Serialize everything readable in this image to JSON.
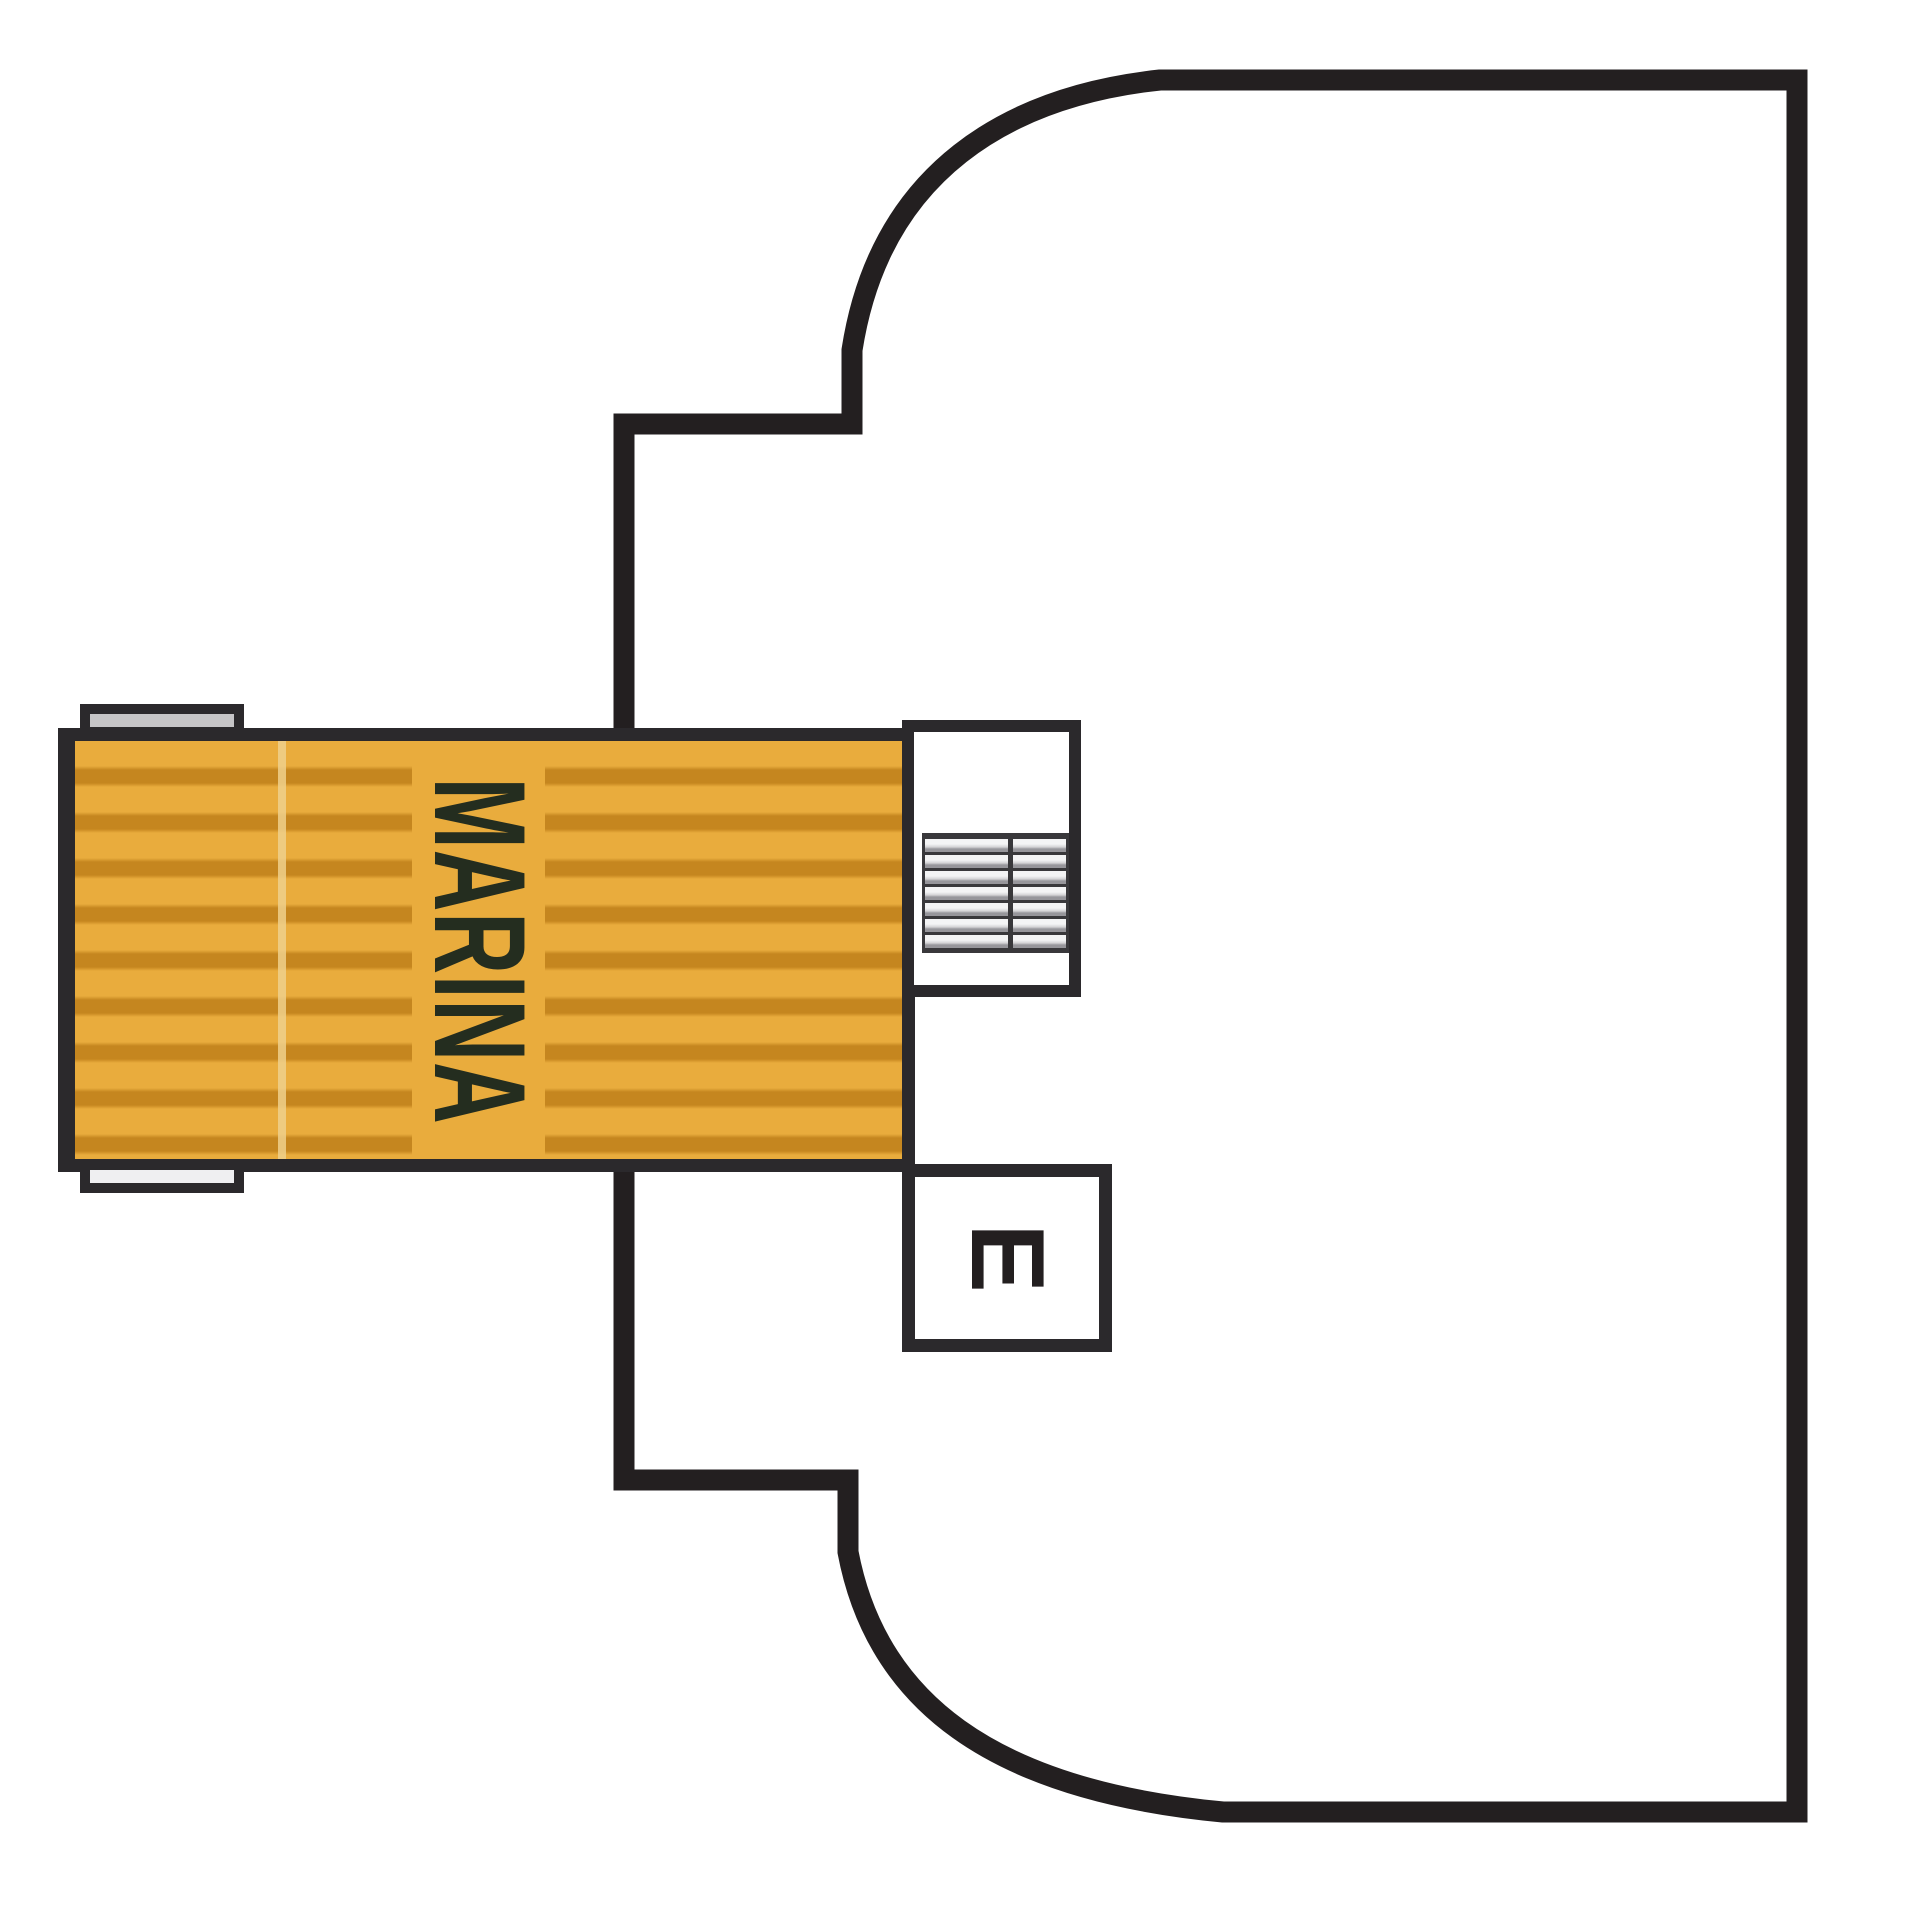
{
  "page": {
    "background": "#FFFFFF"
  },
  "plan": {
    "deck_label": "MARINA",
    "elevator_label": "E",
    "colors": {
      "hull_line": "#231F20",
      "room_line": "#2B292C",
      "deck_base": "#E9AC3D",
      "deck_plank": "#C5861F",
      "deck_seam": "#EFD08C",
      "deck_text": "#242D1F",
      "edge_cap_top": "#C6C5C7",
      "edge_cap_bottom": "#EFEFF1",
      "stair_step_dark": "#39383B",
      "stair_step_mid": "#97969B",
      "stair_step_light": "#F4F4F5"
    },
    "icons": {
      "stairs": "stairs-icon",
      "elevator": "elevator-letter-box"
    }
  }
}
